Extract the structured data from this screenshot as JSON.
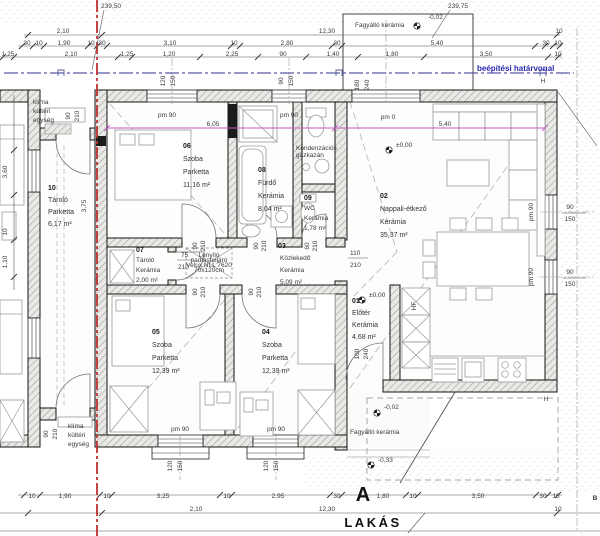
{
  "title": {
    "plan_label": "LAKÁS",
    "section_a": "A"
  },
  "boundary_label": "beépítési határvonal",
  "colors": {
    "boundary_blue": "#2b2bb0",
    "property_red": "#c03030",
    "dim_magenta": "#c45ac4"
  },
  "plot_heights": {
    "top_left": "239,50",
    "top_right": "239,75"
  },
  "rooms": [
    {
      "num": "10",
      "name": "Tároló",
      "floor": "Parketta",
      "area": "6,17 m²"
    },
    {
      "num": "06",
      "name": "Szoba",
      "floor": "Parketta",
      "area": "11,16 m²"
    },
    {
      "num": "08",
      "name": "Fürdő",
      "floor": "Kerámia",
      "area": "8,04 m²"
    },
    {
      "num": "09",
      "name": "WC",
      "floor": "Kerámia",
      "area": "1,78 m²"
    },
    {
      "num": "02",
      "name": "Nappali-étkező",
      "floor": "Kerámia",
      "area": "35,37 m²"
    },
    {
      "num": "07",
      "name": "Tároló",
      "floor": "Kerámia",
      "area": "2,00 m²"
    },
    {
      "num": "03",
      "name": "Közlekedő",
      "floor": "Kerámia",
      "area": "5,09 m²"
    },
    {
      "num": "05",
      "name": "Szoba",
      "floor": "Parketta",
      "area": "12,39 m²"
    },
    {
      "num": "04",
      "name": "Szoba",
      "floor": "Parketta",
      "area": "12,39 m²"
    },
    {
      "num": "01",
      "name": "Előtér",
      "floor": "Kerámia",
      "area": "4,68 m²"
    }
  ],
  "annotations": [
    {
      "t": "239,50",
      "x": 111,
      "y": 8
    },
    {
      "t": "239,75",
      "x": 458,
      "y": 8
    },
    {
      "t": "2,10",
      "x": 63,
      "y": 33
    },
    {
      "t": "12,30",
      "x": 327,
      "y": 33
    },
    {
      "t": "30",
      "x": 27,
      "y": 45,
      "s": 5.5
    },
    {
      "t": "10",
      "x": 39,
      "y": 45,
      "s": 5.5
    },
    {
      "t": "1,90",
      "x": 64,
      "y": 45
    },
    {
      "t": "10",
      "x": 91,
      "y": 45,
      "s": 5.5
    },
    {
      "t": "30",
      "x": 102,
      "y": 45,
      "s": 5.5
    },
    {
      "t": "3,10",
      "x": 170,
      "y": 45
    },
    {
      "t": "10",
      "x": 234,
      "y": 45,
      "s": 5.5
    },
    {
      "t": "2,80",
      "x": 287,
      "y": 45
    },
    {
      "t": "30",
      "x": 337,
      "y": 45,
      "s": 5.5
    },
    {
      "t": "5,40",
      "x": 437,
      "y": 45
    },
    {
      "t": "10",
      "x": 559,
      "y": 33,
      "s": 5.5
    },
    {
      "t": "30",
      "x": 546,
      "y": 45,
      "s": 5.5
    },
    {
      "t": "10",
      "x": 558,
      "y": 45,
      "s": 5.5
    },
    {
      "t": "1,25",
      "x": 8,
      "y": 56
    },
    {
      "t": "2,10",
      "x": 71,
      "y": 56
    },
    {
      "t": "1,25",
      "x": 127,
      "y": 56
    },
    {
      "t": "1,20",
      "x": 169,
      "y": 56
    },
    {
      "t": "2,25",
      "x": 232,
      "y": 56
    },
    {
      "t": "90",
      "x": 283,
      "y": 56,
      "s": 5.5
    },
    {
      "t": "1,40",
      "x": 333,
      "y": 56
    },
    {
      "t": "1,80",
      "x": 392,
      "y": 56
    },
    {
      "t": "3,50",
      "x": 486,
      "y": 56
    },
    {
      "t": "10",
      "x": 558,
      "y": 56,
      "s": 5.5
    },
    {
      "t": "Fagyálló kerámia",
      "x": 355,
      "y": 27,
      "a": "start",
      "f": "#777",
      "s": 7
    },
    {
      "t": "-0,02",
      "x": 428,
      "y": 19,
      "a": "start"
    },
    {
      "t": "klíma",
      "x": 33,
      "y": 104,
      "a": "start"
    },
    {
      "t": "kültéri",
      "x": 33,
      "y": 113,
      "a": "start"
    },
    {
      "t": "egység",
      "x": 33,
      "y": 122,
      "a": "start"
    },
    {
      "t": "3,60",
      "x": 7,
      "y": 172,
      "r": -90
    },
    {
      "t": "10",
      "x": 7,
      "y": 232,
      "r": -90,
      "s": 5.5
    },
    {
      "t": "1,10",
      "x": 7,
      "y": 262,
      "r": -90
    },
    {
      "t": "90",
      "x": 70,
      "y": 116,
      "r": -90,
      "s": 5.5
    },
    {
      "t": "210",
      "x": 79,
      "y": 116,
      "r": -90,
      "s": 5.5
    },
    {
      "t": "3,75",
      "x": 86,
      "y": 206,
      "r": -90
    },
    {
      "t": "pm 90",
      "x": 167,
      "y": 117,
      "s": 6
    },
    {
      "t": "pm 90",
      "x": 289,
      "y": 117,
      "s": 6
    },
    {
      "t": "pm 0",
      "x": 388,
      "y": 119,
      "s": 6
    },
    {
      "t": "pm 90",
      "x": 180,
      "y": 431,
      "s": 6
    },
    {
      "t": "pm 90",
      "x": 276,
      "y": 431,
      "s": 6
    },
    {
      "t": "pm 90",
      "x": 533,
      "y": 212,
      "r": -90,
      "s": 6
    },
    {
      "t": "pm 90",
      "x": 533,
      "y": 277,
      "r": -90,
      "s": 6
    },
    {
      "t": "120",
      "x": 165,
      "y": 81,
      "r": -90,
      "s": 5.5
    },
    {
      "t": "150",
      "x": 175,
      "y": 81,
      "r": -90,
      "s": 5.5
    },
    {
      "t": "90",
      "x": 283,
      "y": 81,
      "r": -90,
      "s": 5.5
    },
    {
      "t": "150",
      "x": 293,
      "y": 81,
      "r": -90,
      "s": 5.5
    },
    {
      "t": "180",
      "x": 359,
      "y": 85,
      "r": -90,
      "s": 5.5
    },
    {
      "t": "240",
      "x": 369,
      "y": 85,
      "r": -90,
      "s": 5.5
    },
    {
      "t": "90",
      "x": 570,
      "y": 209,
      "s": 5.5
    },
    {
      "t": "150",
      "x": 570,
      "y": 221,
      "s": 5.5
    },
    {
      "t": "90",
      "x": 570,
      "y": 274,
      "s": 5.5
    },
    {
      "t": "150",
      "x": 570,
      "y": 286,
      "s": 5.5
    },
    {
      "t": "120",
      "x": 172,
      "y": 466,
      "r": -90,
      "s": 5.5
    },
    {
      "t": "150",
      "x": 182,
      "y": 466,
      "r": -90,
      "s": 5.5
    },
    {
      "t": "120",
      "x": 268,
      "y": 466,
      "r": -90,
      "s": 5.5
    },
    {
      "t": "150",
      "x": 278,
      "y": 466,
      "r": -90,
      "s": 5.5
    },
    {
      "t": "90",
      "x": 48,
      "y": 434,
      "r": -90,
      "s": 5.5
    },
    {
      "t": "210",
      "x": 57,
      "y": 434,
      "r": -90,
      "s": 5.5
    },
    {
      "t": "6,05",
      "x": 213,
      "y": 126,
      "f": "#c45ac4",
      "s": 7
    },
    {
      "t": "5,40",
      "x": 445,
      "y": 126,
      "f": "#c45ac4",
      "s": 7
    },
    {
      "t": "90",
      "x": 197,
      "y": 246,
      "r": -90,
      "s": 5
    },
    {
      "t": "210",
      "x": 205,
      "y": 246,
      "r": -90,
      "s": 5
    },
    {
      "t": "90",
      "x": 258,
      "y": 246,
      "r": -90,
      "s": 5
    },
    {
      "t": "210",
      "x": 266,
      "y": 246,
      "r": -90,
      "s": 5
    },
    {
      "t": "60",
      "x": 309,
      "y": 246,
      "r": -90,
      "s": 5
    },
    {
      "t": "210",
      "x": 317,
      "y": 246,
      "r": -90,
      "s": 5
    },
    {
      "t": "90",
      "x": 197,
      "y": 292,
      "r": -90,
      "s": 5
    },
    {
      "t": "210",
      "x": 205,
      "y": 292,
      "r": -90,
      "s": 5
    },
    {
      "t": "90",
      "x": 253,
      "y": 292,
      "r": -90,
      "s": 5
    },
    {
      "t": "210",
      "x": 261,
      "y": 292,
      "r": -90,
      "s": 5
    },
    {
      "t": "75",
      "x": 181,
      "y": 257,
      "a": "start",
      "s": 6
    },
    {
      "t": "210",
      "x": 178,
      "y": 269,
      "a": "start",
      "s": 6
    },
    {
      "t": "110",
      "x": 350,
      "y": 255,
      "a": "start",
      "s": 6
    },
    {
      "t": "210",
      "x": 350,
      "y": 267,
      "a": "start",
      "s": 6
    },
    {
      "t": "100",
      "x": 359,
      "y": 354,
      "r": -90,
      "s": 5
    },
    {
      "t": "240",
      "x": 368,
      "y": 354,
      "r": -90,
      "s": 5
    },
    {
      "t": "Kondenzációs",
      "x": 296,
      "y": 150,
      "a": "start",
      "s": 5
    },
    {
      "t": "gázkazán",
      "x": 296,
      "y": 157,
      "a": "start",
      "s": 5
    },
    {
      "t": "Lenyíló",
      "x": 209,
      "y": 257,
      "s": 4.2
    },
    {
      "t": "padlásfeljáró",
      "x": 209,
      "y": 262,
      "s": 4.2
    },
    {
      "t": "Velux NLL 7620",
      "x": 209,
      "y": 267,
      "s": 4.2
    },
    {
      "t": "70x120cm",
      "x": 209,
      "y": 272,
      "s": 4.2
    },
    {
      "t": "HF",
      "x": 416,
      "y": 306,
      "r": -90,
      "s": 6
    },
    {
      "t": "±0,00",
      "x": 396,
      "y": 147,
      "a": "start"
    },
    {
      "t": "±0,00",
      "x": 369,
      "y": 297,
      "a": "start"
    },
    {
      "t": "-0,02",
      "x": 384,
      "y": 409,
      "a": "start"
    },
    {
      "t": "Fagyálló kerámia",
      "x": 350,
      "y": 434,
      "a": "start",
      "s": 6.5,
      "f": "#777"
    },
    {
      "t": "-0,33",
      "x": 378,
      "y": 462,
      "a": "start"
    },
    {
      "t": "H",
      "x": 543,
      "y": 83,
      "s": 6
    },
    {
      "t": "H",
      "x": 546,
      "y": 401,
      "s": 6
    },
    {
      "t": "B",
      "x": 595,
      "y": 500,
      "s": 10,
      "w": "bold"
    },
    {
      "t": "klíma",
      "x": 68,
      "y": 428,
      "a": "start"
    },
    {
      "t": "kültéri",
      "x": 68,
      "y": 437,
      "a": "start"
    },
    {
      "t": "egység",
      "x": 68,
      "y": 446,
      "a": "start"
    },
    {
      "t": "10",
      "x": 32,
      "y": 498,
      "s": 5.5
    },
    {
      "t": "1,90",
      "x": 65,
      "y": 498
    },
    {
      "t": "10",
      "x": 107,
      "y": 498,
      "s": 5.5
    },
    {
      "t": "3,25",
      "x": 163,
      "y": 498
    },
    {
      "t": "10",
      "x": 227,
      "y": 498,
      "s": 5.5
    },
    {
      "t": "2,95",
      "x": 278,
      "y": 498
    },
    {
      "t": "30",
      "x": 337,
      "y": 498,
      "s": 5.5
    },
    {
      "t": "1,80",
      "x": 383,
      "y": 498
    },
    {
      "t": "10",
      "x": 413,
      "y": 498,
      "s": 5.5
    },
    {
      "t": "3,50",
      "x": 478,
      "y": 498
    },
    {
      "t": "30",
      "x": 543,
      "y": 498,
      "s": 5.5
    },
    {
      "t": "10",
      "x": 556,
      "y": 498,
      "s": 5.5
    },
    {
      "t": "2,10",
      "x": 196,
      "y": 511
    },
    {
      "t": "12,30",
      "x": 327,
      "y": 511
    },
    {
      "t": "10",
      "x": 558,
      "y": 511,
      "s": 5.5
    }
  ]
}
